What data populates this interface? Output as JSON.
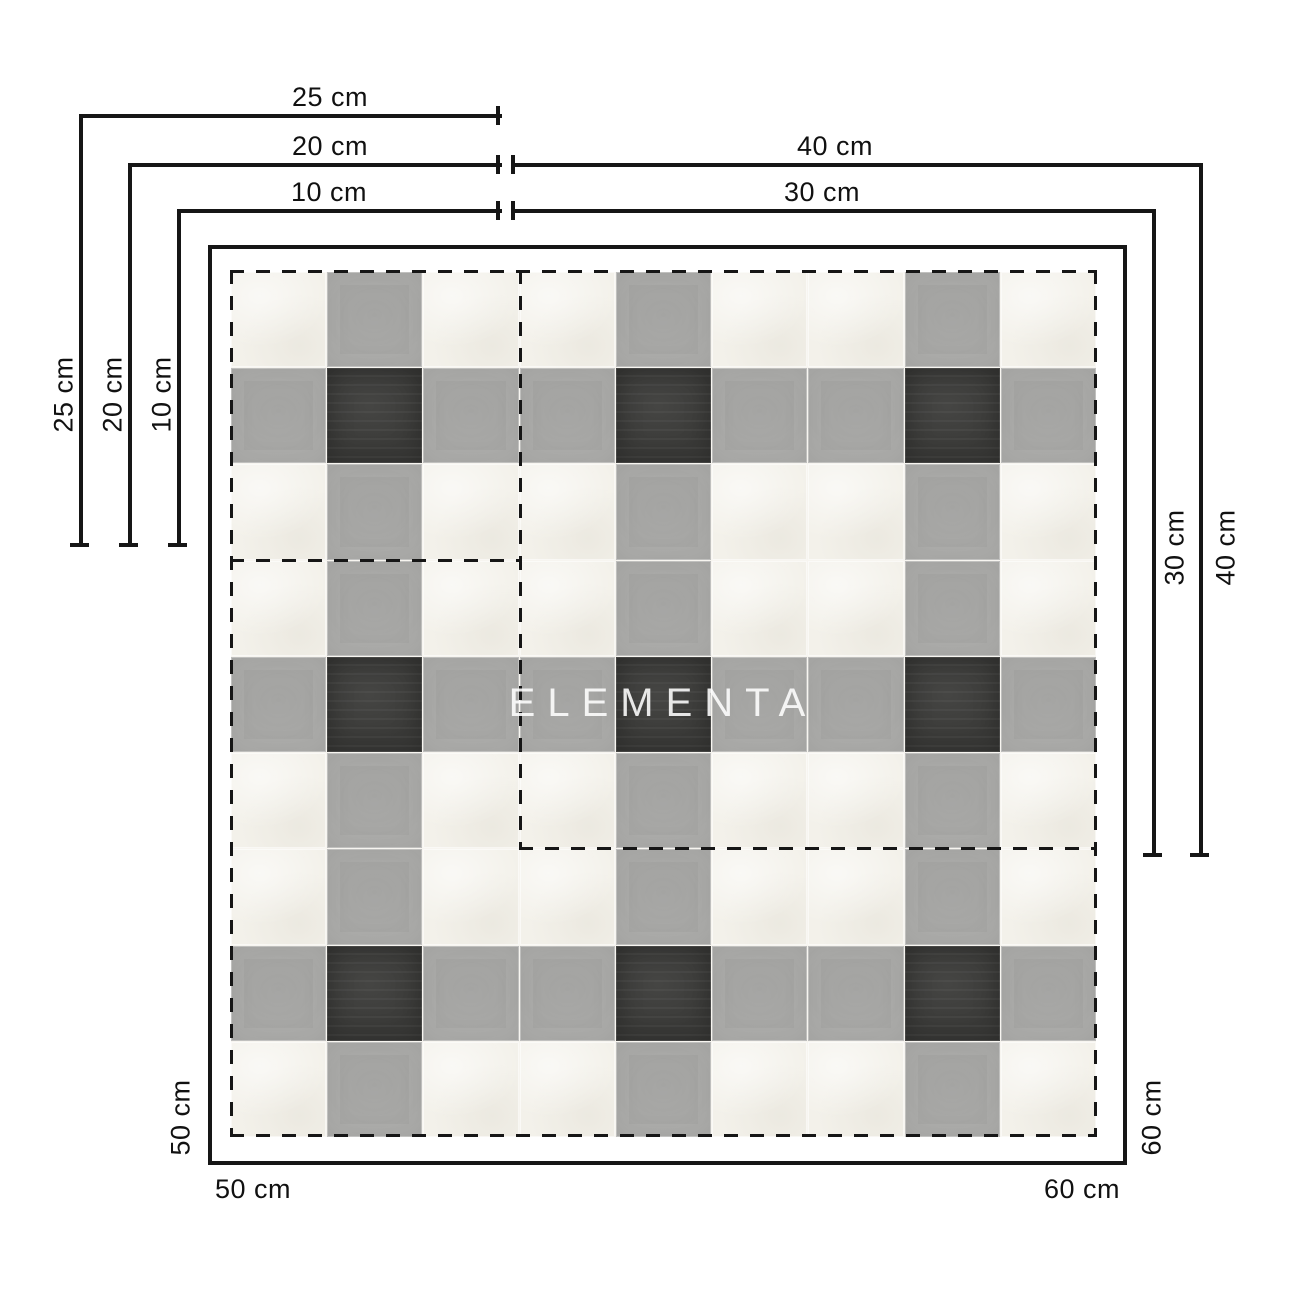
{
  "watermark": {
    "text": "ELEMENTA",
    "color": "#ffffff"
  },
  "labels": {
    "d10": "10 cm",
    "d20": "20 cm",
    "d25": "25 cm",
    "d30": "30 cm",
    "d40": "40 cm",
    "d50": "50 cm",
    "d60": "60 cm"
  },
  "tile_size_options": [
    "10 cm",
    "20 cm",
    "25 cm",
    "30 cm",
    "40 cm",
    "50 cm",
    "60 cm"
  ],
  "colors": {
    "background": "#ffffff",
    "line": "#161616",
    "label": "#111111"
  },
  "pattern": {
    "grid_size": 9,
    "gray_rows": [
      1,
      4,
      7
    ],
    "gray_cols": [
      1,
      4,
      7
    ],
    "colors": {
      "white_tile": "#f3f1ea",
      "gray_tile": "#a8a8a6",
      "dark_tile": "#3a3a38",
      "grout": "#f7f5f0"
    }
  }
}
